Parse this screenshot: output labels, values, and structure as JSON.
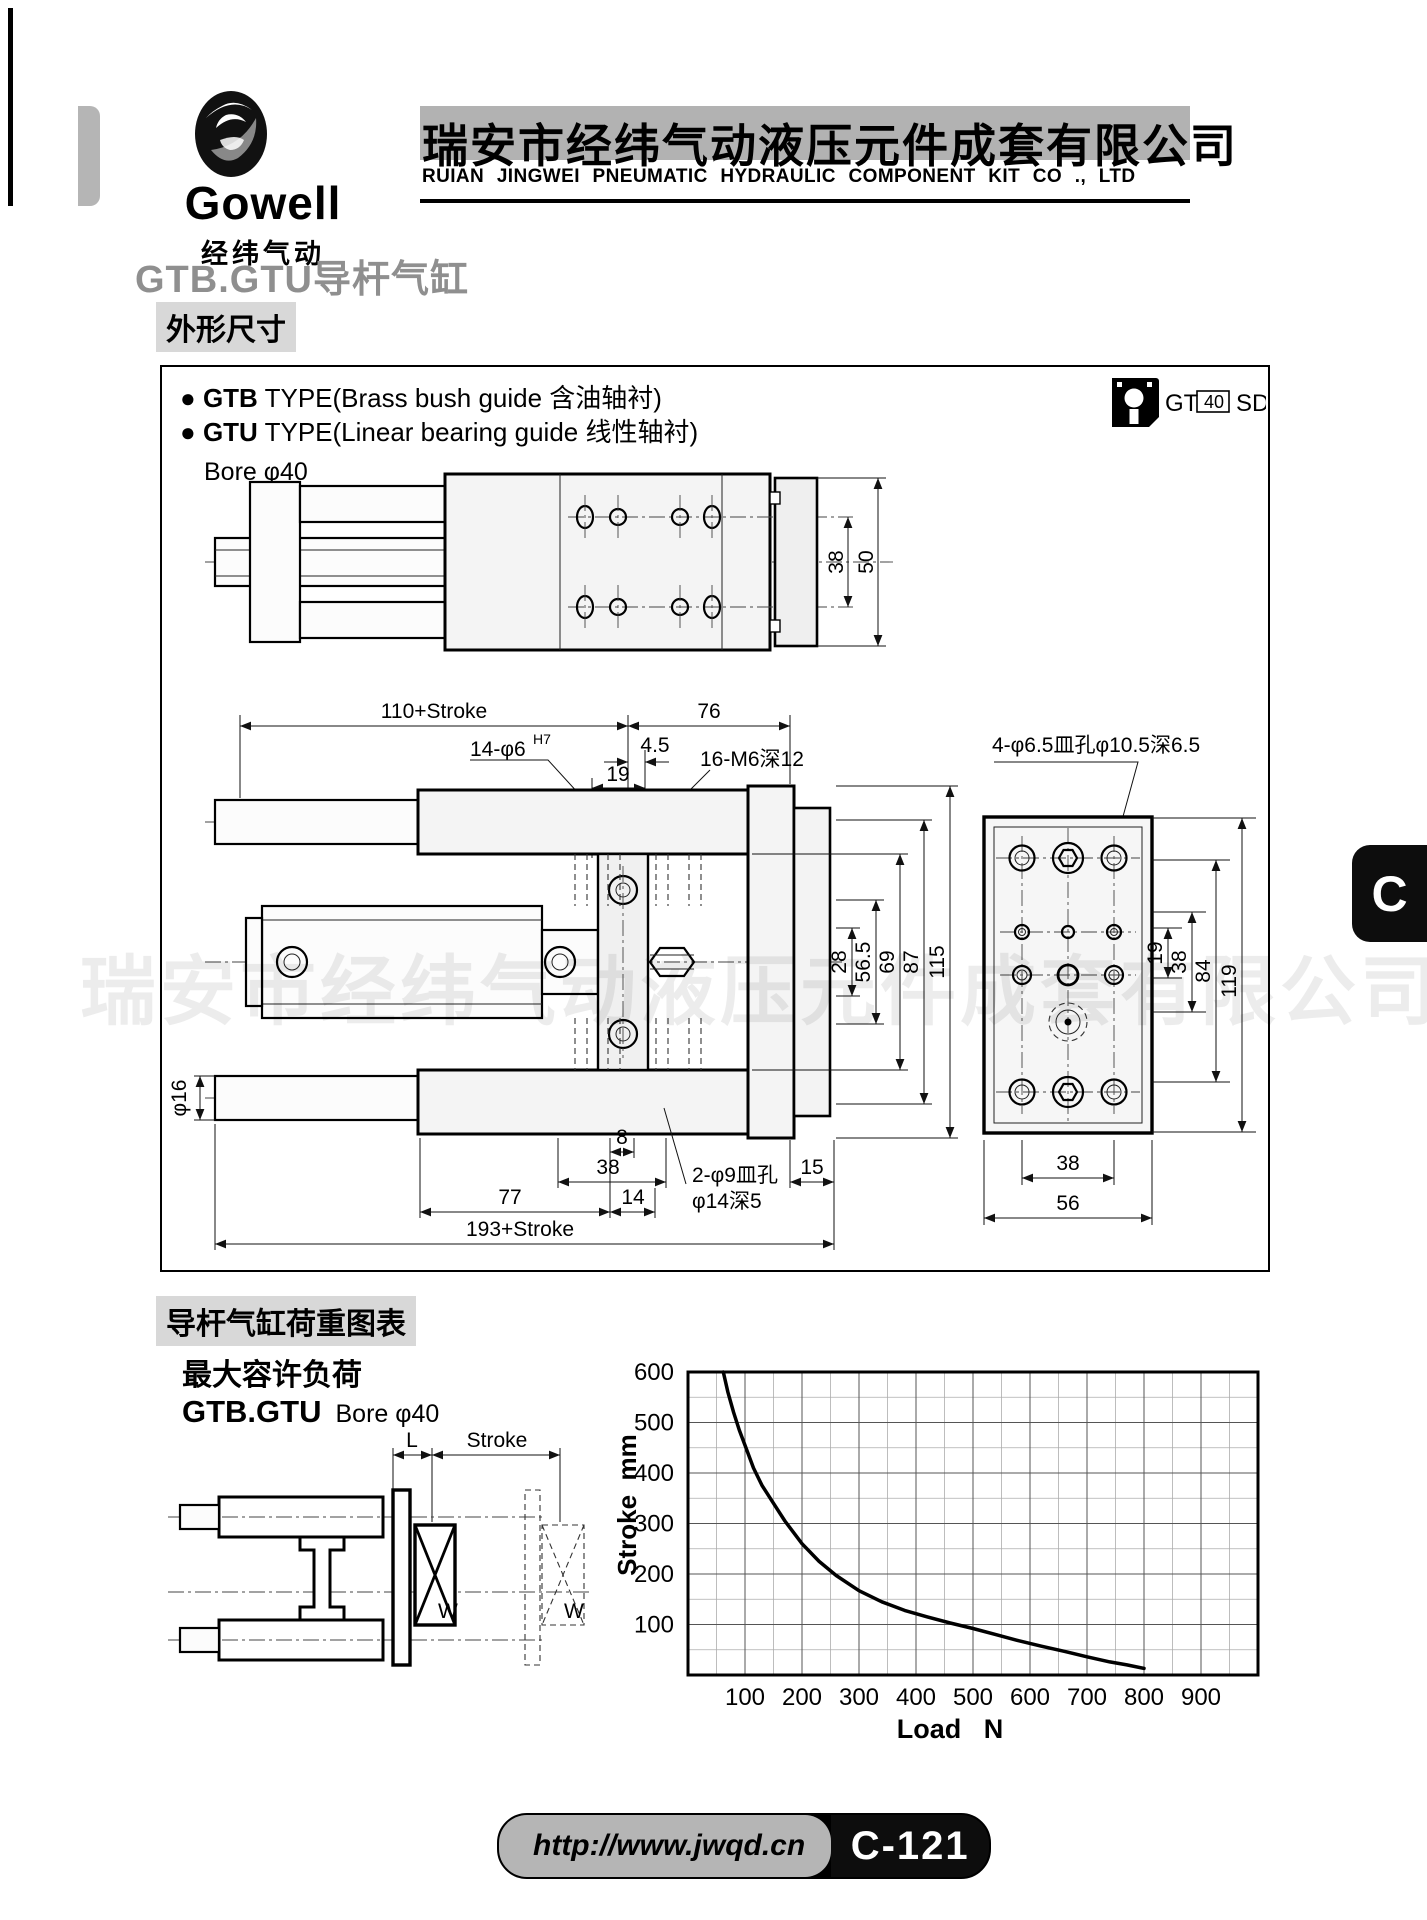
{
  "header": {
    "logo_name": "Gowell",
    "logo_caption": "经纬气动",
    "company_cn": "瑞安市经纬气动液压元件成套有限公司",
    "company_en": "RUIAN JINGWEI PNEUMATIC HYDRAULIC COMPONENT KIT CO ., LTD"
  },
  "page_title": "GTB.GTU导杆气缸",
  "dims_section": {
    "heading": "外形尺寸",
    "bullet_glyph": "●",
    "types": [
      {
        "model": "GTB",
        "desc": " TYPE(Brass bush guide 含油轴衬)"
      },
      {
        "model": "GTU",
        "desc": " TYPE(Linear bearing guide 线性轴衬)"
      }
    ],
    "bore": "Bore φ40",
    "order_code": {
      "prefix": "GT",
      "bore": "40",
      "suffix": "SD"
    },
    "side_view": {
      "dim_38": "38",
      "dim_50": "50"
    },
    "front_view": {
      "dim_110_stroke": "110+Stroke",
      "dim_76": "76",
      "callout_phi6": "14-φ6",
      "callout_phi6_sup": "H7",
      "dim_45": "4.5",
      "callout_m6": "16-M6深12",
      "dim_19": "19",
      "dim_28": "28",
      "dim_565": "56.5",
      "dim_69": "69",
      "dim_87": "87",
      "dim_115": "115",
      "dim_phi16": "φ16",
      "dim_8": "8",
      "dim_38": "38",
      "dim_15": "15",
      "dim_77": "77",
      "dim_14": "14",
      "dim_193_stroke": "193+Stroke",
      "callout_phi9_line1": "2-φ9皿孔",
      "callout_phi9_line2": "φ14深5"
    },
    "end_view": {
      "callout": "4-φ6.5皿孔φ10.5深6.5",
      "dim_19": "19",
      "dim_38": "38",
      "dim_84": "84",
      "dim_119": "119",
      "dim_38b": "38",
      "dim_56": "56"
    }
  },
  "load_section": {
    "heading": "导杆气缸荷重图表",
    "subheading": "最大容许负荷",
    "model": "GTB.GTU",
    "bore": "Bore φ40",
    "diagram": {
      "dim_l": "L",
      "dim_stroke": "Stroke",
      "load_w_solid": "W",
      "load_w_ghost": "W"
    }
  },
  "chart_data": {
    "type": "line",
    "title": "最大容许负荷 (maximum allowable load)",
    "xlabel": "Load   N",
    "ylabel": "Stroke  mm",
    "xlim": [
      0,
      1000
    ],
    "ylim": [
      0,
      600
    ],
    "x_ticks": [
      100,
      200,
      300,
      400,
      500,
      600,
      700,
      800,
      900
    ],
    "y_ticks": [
      100,
      200,
      300,
      400,
      500,
      600
    ],
    "minor_grid_step": 50,
    "grid": true,
    "legend": "none",
    "series": [
      {
        "name": "GTB.GTU Bore φ40 maximum allowable load",
        "points": [
          [
            62,
            600
          ],
          [
            70,
            560
          ],
          [
            80,
            520
          ],
          [
            90,
            485
          ],
          [
            100,
            455
          ],
          [
            115,
            410
          ],
          [
            130,
            375
          ],
          [
            150,
            340
          ],
          [
            170,
            305
          ],
          [
            200,
            260
          ],
          [
            230,
            225
          ],
          [
            260,
            197
          ],
          [
            300,
            167
          ],
          [
            340,
            145
          ],
          [
            380,
            128
          ],
          [
            420,
            115
          ],
          [
            460,
            103
          ],
          [
            500,
            92
          ],
          [
            540,
            80
          ],
          [
            580,
            68
          ],
          [
            620,
            57
          ],
          [
            660,
            47
          ],
          [
            700,
            36
          ],
          [
            740,
            26
          ],
          [
            770,
            20
          ],
          [
            800,
            13
          ]
        ]
      }
    ]
  },
  "watermark": "瑞安市经纬气动液压元件成套有限公司",
  "footer": {
    "url": "http://www.jwqd.cn",
    "page_no": "C-121"
  },
  "side_tab": "C"
}
